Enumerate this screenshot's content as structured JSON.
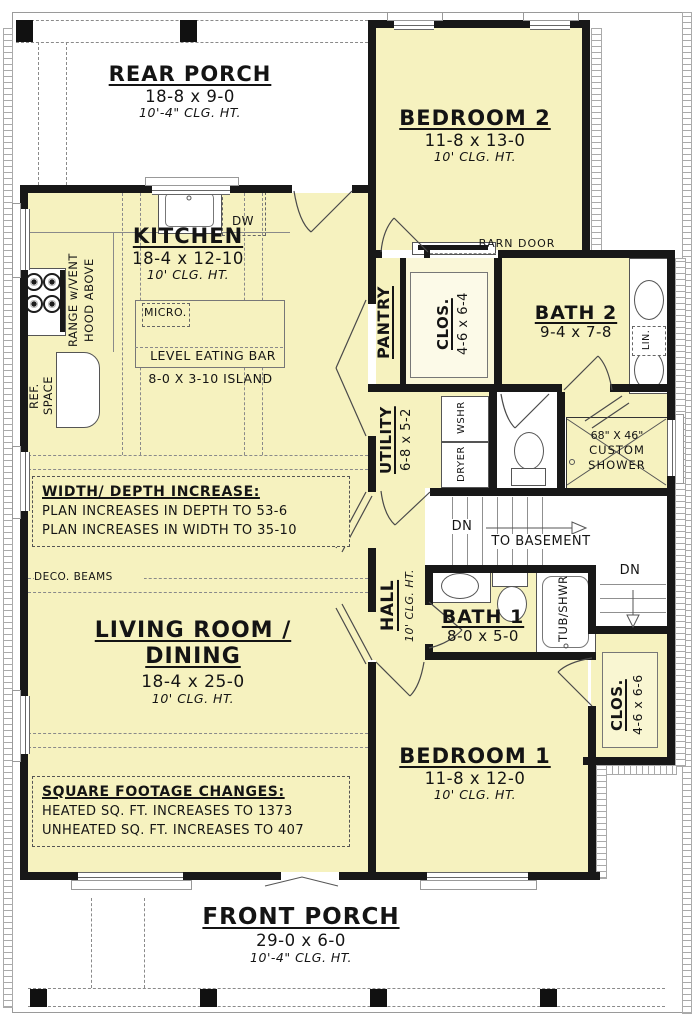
{
  "rooms": {
    "rear_porch": {
      "name": "REAR PORCH",
      "dims": "18-8 x 9-0",
      "clg": "10'-4\" CLG. HT."
    },
    "bedroom2": {
      "name": "BEDROOM 2",
      "dims": "11-8 x 13-0",
      "clg": "10' CLG. HT."
    },
    "kitchen": {
      "name": "KITCHEN",
      "dims": "18-4 x 12-10",
      "clg": "10' CLG. HT."
    },
    "pantry": {
      "name": "PANTRY"
    },
    "closet_top": {
      "name": "CLOS.",
      "dims": "4-6 x 6-4"
    },
    "bath2": {
      "name": "BATH 2",
      "dims": "9-4 x 7-8"
    },
    "utility": {
      "name": "UTILITY",
      "dims": "6-8 x 5-2"
    },
    "hall": {
      "name": "HALL",
      "clg": "10' CLG. HT."
    },
    "bath1": {
      "name": "BATH 1",
      "dims": "8-0 x 5-0"
    },
    "closet_bottom": {
      "name": "CLOS.",
      "dims": "4-6 x 6-6"
    },
    "bedroom1": {
      "name": "BEDROOM 1",
      "dims": "11-8 x 12-0",
      "clg": "10' CLG. HT."
    },
    "living": {
      "name_line1": "LIVING ROOM /",
      "name_line2": "DINING",
      "dims": "18-4 x 25-0",
      "clg": "10' CLG. HT."
    },
    "front_porch": {
      "name": "FRONT PORCH",
      "dims": "29-0 x 6-0",
      "clg": "10'-4\" CLG. HT."
    }
  },
  "labels": {
    "barn_door": "BARN DOOR",
    "dw": "DW",
    "micro": "MICRO.",
    "eating_bar": "LEVEL EATING BAR",
    "island": "8-0 X 3-10 ISLAND",
    "range_l1": "RANGE w/VENT",
    "range_l2": "HOOD ABOVE",
    "ref_l1": "REF.",
    "ref_l2": "SPACE",
    "lin": "LIN.",
    "wshr": "WSHR",
    "dryer": "DRYER",
    "shower_l1": "68\" X 46\"",
    "shower_l2": "CUSTOM",
    "shower_l3": "SHOWER",
    "dn": "DN",
    "to_basement": "TO BASEMENT",
    "tub_shwr": "TUB/SHWR",
    "deco_beams": "DECO. BEAMS"
  },
  "notes": {
    "wd_title": "WIDTH/ DEPTH INCREASE:",
    "wd_line1": "PLAN INCREASES IN DEPTH TO 53-6",
    "wd_line2": "PLAN INCREASES IN WIDTH TO 35-10",
    "sf_title": "SQUARE FOOTAGE CHANGES:",
    "sf_line1": "HEATED SQ. FT. INCREASES TO 1373",
    "sf_line2": "UNHEATED SQ. FT. INCREASES TO 407"
  },
  "colors": {
    "room_fill": "#F6F2BF",
    "wall": "#181818",
    "porch_fill": "#FFFFFF"
  }
}
